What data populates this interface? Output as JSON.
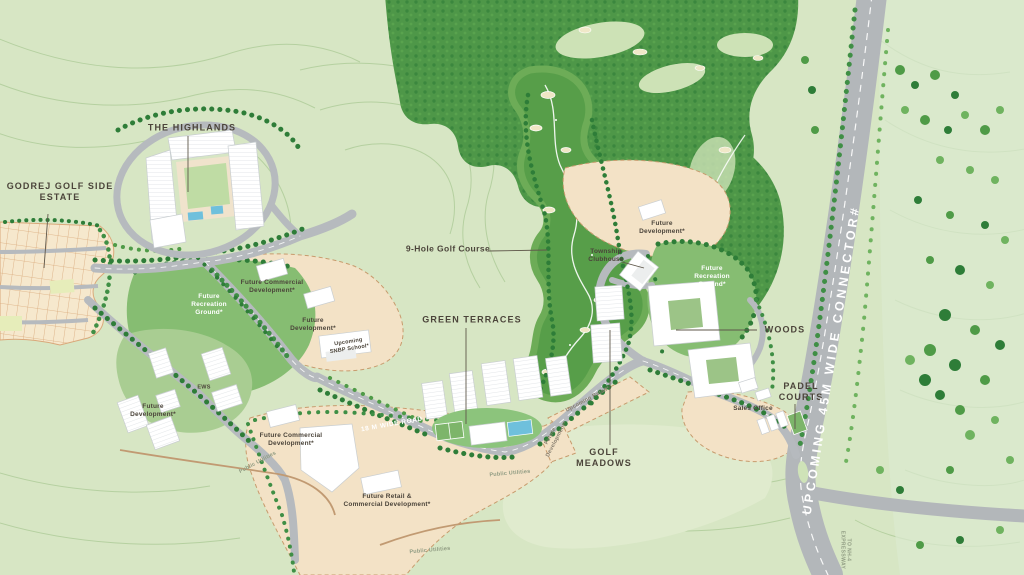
{
  "map": {
    "kind": "township-masterplan",
    "project_name": "GODREJ GOLF SIDE ESTATE"
  },
  "colors": {
    "base_green": "#d7e6c4",
    "pale_green": "#e0ebce",
    "contour_line": "#b5d0a0",
    "mid_green": "#86bd72",
    "forest_green": "#4e9748",
    "tree_dark": "#2e7d38",
    "golf_green": "#579e49",
    "road_gray": "#b6babe",
    "beige_development": "#f3e2c6",
    "plot_cream": "#f6e8cd",
    "plot_line": "#d9a87a",
    "building_white": "#ffffff",
    "pool_blue": "#6fc0dc",
    "label_dark": "#4b443a",
    "label_white": "#ffffff",
    "utility_text": "#8f9b82"
  },
  "labels": {
    "highlands": "THE HIGHLANDS",
    "estate": "GODREJ GOLF SIDE\nESTATE",
    "golf_course": "9-Hole Golf Course",
    "green_terraces": "GREEN TERRACES",
    "township_clubhouse": "Township\nClubhouse",
    "woods": "WOODS",
    "padel_courts": "PADEL\nCOURTS",
    "sales_office": "Sales Office",
    "golf_meadows": "GOLF\nMEADOWS",
    "connector_road": "UPCOMING 45M WIDE CONNECTOR#",
    "road_18m": "18 M WIDE ROAD",
    "upcoming_retail": "Upcoming Retail*",
    "future_dev_strip": "Future\nDevelopment*",
    "future_dev_north": "Future\nDevelopment*",
    "future_dev_school": "Future\nDevelopment*",
    "future_dev_sw": "Future\nDevelopment*",
    "future_rec_ground_w": "Future\nRecreation\nGround*",
    "future_rec_ground_e": "Future\nRecreation\nGround*",
    "future_comm_north": "Future Commercial\nDevelopment*",
    "future_comm_south": "Future Commercial\nDevelopment*",
    "future_retail": "Future Retail &\nCommercial Development*",
    "upcoming_school": "Upcoming\nSNBP School*",
    "ews": "EWS",
    "public_utilities_1": "Public Utilities",
    "public_utilities_2": "Public Utilities",
    "public_utilities_3": "Public Utilities",
    "to_nh4": "TO NH-4\nEXPRESSWAY"
  }
}
